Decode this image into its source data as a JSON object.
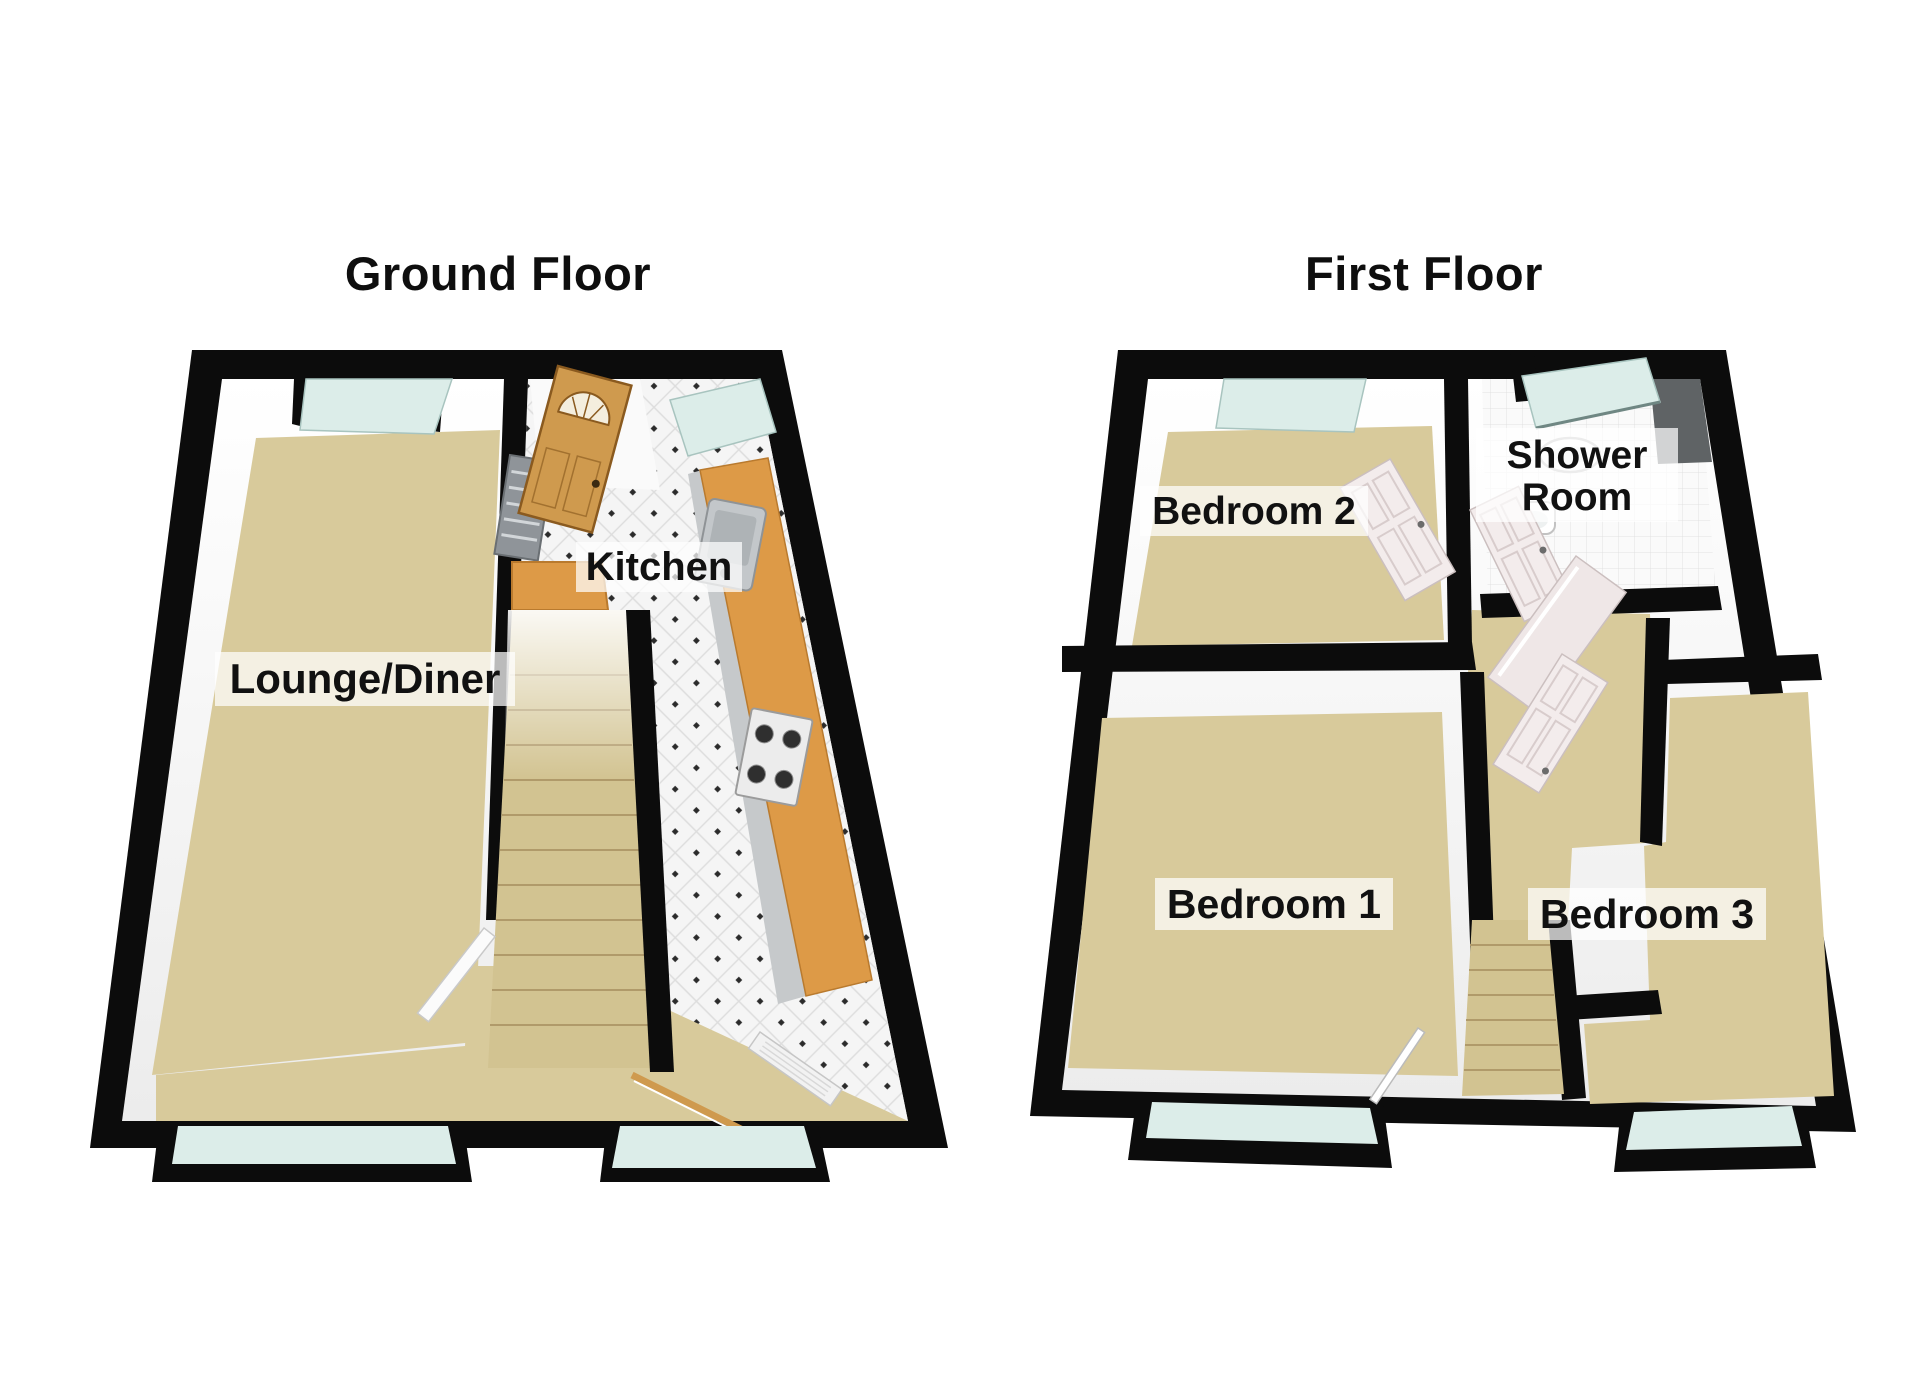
{
  "page": {
    "type": "3d-floorplan",
    "background": "#ffffff"
  },
  "floors": [
    {
      "id": "ground-floor",
      "title": "Ground Floor",
      "rooms": [
        {
          "label": "Lounge/Diner"
        },
        {
          "label": "Kitchen"
        }
      ],
      "visible_elements": [
        "staircase",
        "entrance-door",
        "kitchen-counter",
        "sink",
        "gas-hob",
        "stair-banister",
        "windows"
      ]
    },
    {
      "id": "first-floor",
      "title": "First Floor",
      "rooms": [
        {
          "label": "Bedroom 2"
        },
        {
          "label": "Shower Room",
          "line1": "Shower",
          "line2": "Room"
        },
        {
          "label": "Bedroom 1"
        },
        {
          "label": "Bedroom 3"
        }
      ],
      "visible_elements": [
        "staircase",
        "open-doors",
        "wash-basin",
        "toilet",
        "shower-cubicle",
        "windows"
      ]
    }
  ],
  "colors": {
    "wall": "#0c0c0c",
    "cavity": "#fcfcfc",
    "carpet": "#d8ca9b",
    "stair": "#d2c391",
    "counter": "#dd9a47",
    "cabinet": "#c6c9cb",
    "metal": "#c3c7ca",
    "metal_dark": "#aeb3b6",
    "glass": "#dcede9",
    "glass_edge": "#9fbcb8",
    "door_wood": "#cf9a4e",
    "door_wood_edge": "#8a5a1f",
    "door_white": "#f3ecec",
    "door_white_edge": "#c9bcbc",
    "panel_grey": "#8f9499",
    "dark_tile": "#5f6365",
    "label_bg": "rgba(255,255,255,0.72)",
    "label_text": "#111111"
  }
}
